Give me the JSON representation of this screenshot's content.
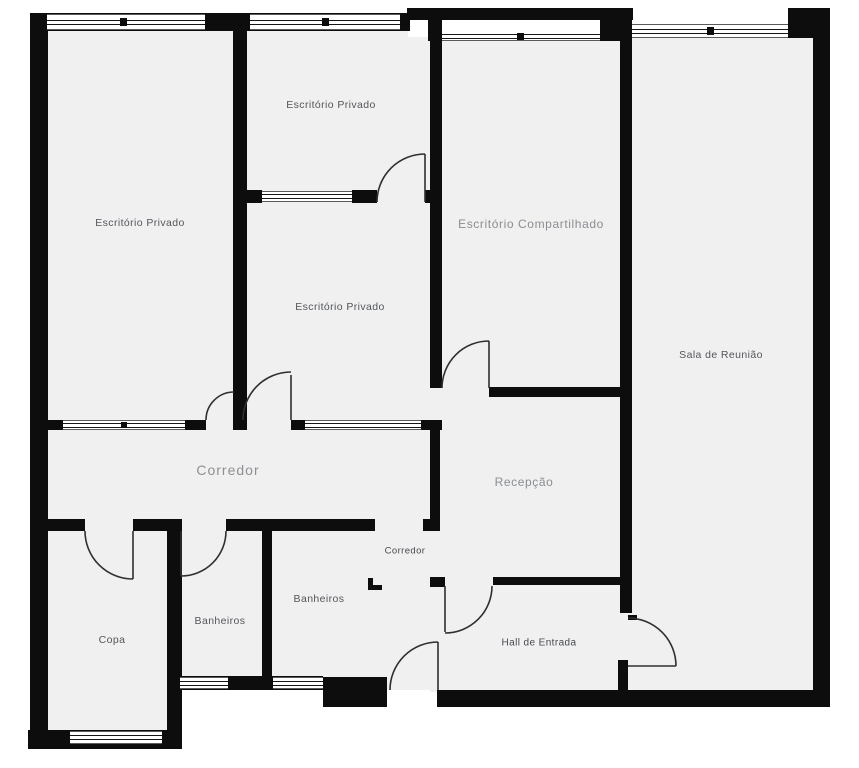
{
  "palette": {
    "wall": "#0d0d0d",
    "floor": "#f0f0f1",
    "background": "#ffffff",
    "door_arc": "#2f2f2f",
    "label_dark": "#53565a",
    "label_light": "#8d9093"
  },
  "rooms": [
    {
      "id": "escritorio-privado-oeste",
      "label": "Escritório Privado"
    },
    {
      "id": "escritorio-privado-norte",
      "label": "Escritório Privado"
    },
    {
      "id": "escritorio-privado-centro",
      "label": "Escritório Privado"
    },
    {
      "id": "escritorio-compartilhado",
      "label": "Escritório Compartilhado"
    },
    {
      "id": "sala-de-reuniao",
      "label": "Sala de Reunião"
    },
    {
      "id": "corredor-principal",
      "label": "Corredor"
    },
    {
      "id": "recepcao",
      "label": "Recepção"
    },
    {
      "id": "corredor-servico",
      "label": "Corredor"
    },
    {
      "id": "banheiros-direita",
      "label": "Banheiros"
    },
    {
      "id": "banheiros-esquerda",
      "label": "Banheiros"
    },
    {
      "id": "copa",
      "label": "Copa"
    },
    {
      "id": "hall-de-entrada",
      "label": "Hall de Entrada"
    }
  ]
}
